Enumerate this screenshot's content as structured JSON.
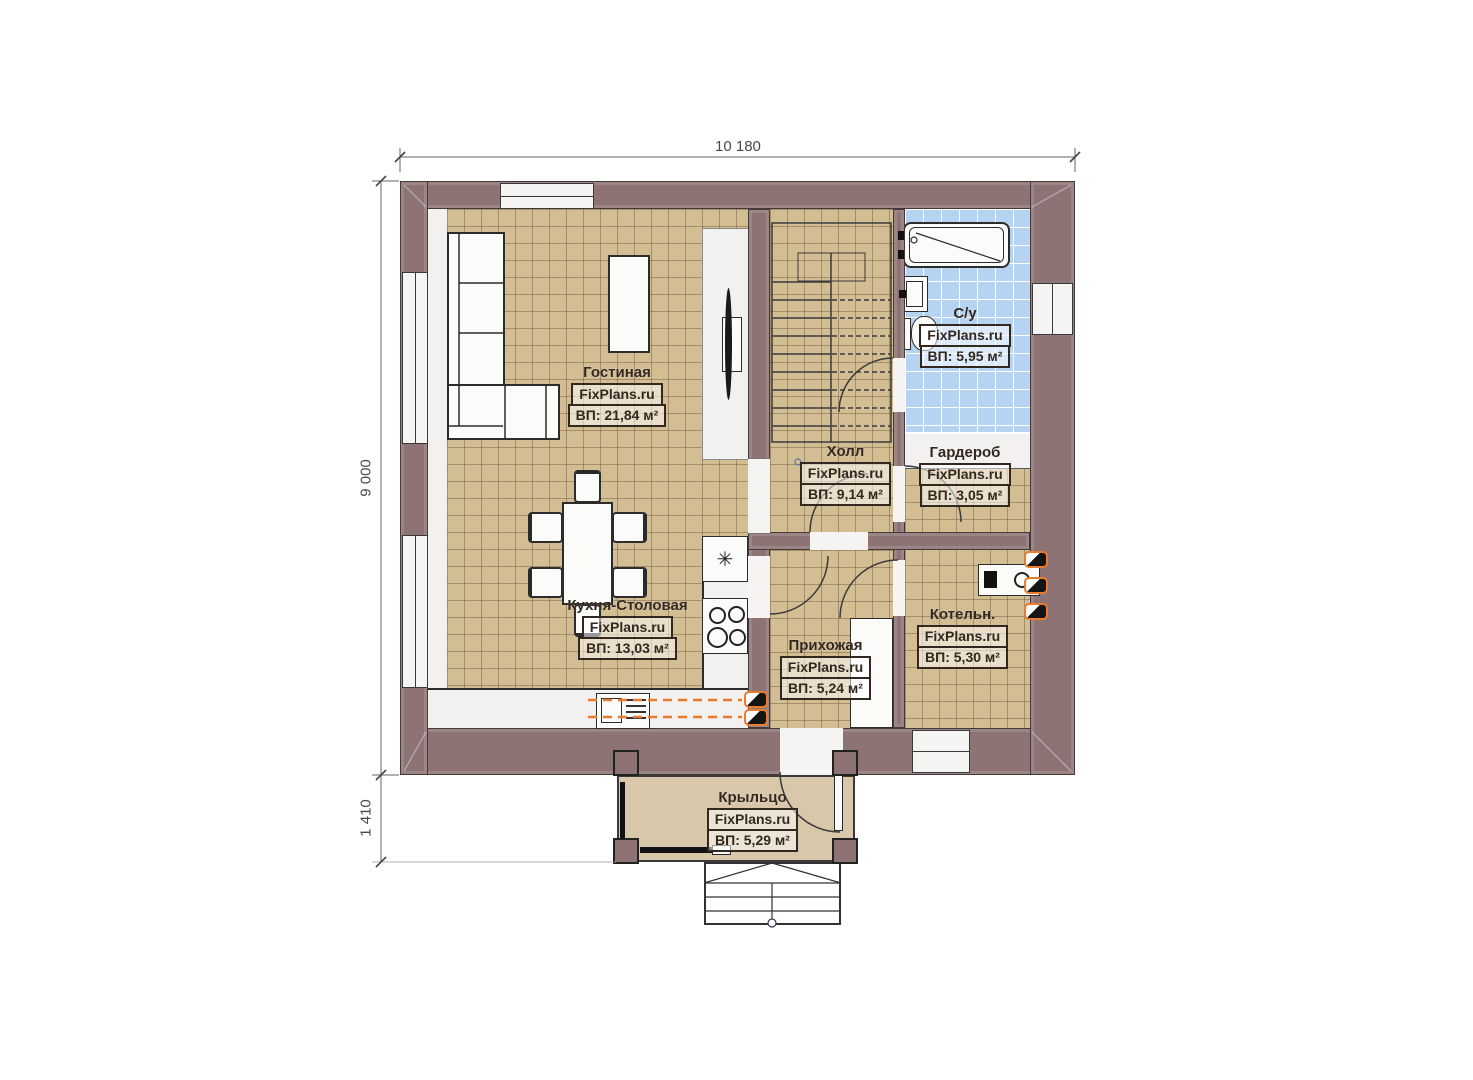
{
  "meta": {
    "brand": "FixPlans.ru",
    "drawing": "first-floor-plan"
  },
  "dimensions": {
    "width_total": "10 180",
    "height_main": "9 000",
    "height_porch": "1 410"
  },
  "rooms": [
    {
      "key": "living",
      "name": "Гостиная",
      "brand": "FixPlans.ru",
      "area": "ВП: 21,84 м²"
    },
    {
      "key": "kitchen",
      "name": "Кухня-Столовая",
      "brand": "FixPlans.ru",
      "area": "ВП: 13,03 м²"
    },
    {
      "key": "hall",
      "name": "Холл",
      "brand": "FixPlans.ru",
      "area": "ВП: 9,14 м²"
    },
    {
      "key": "bathroom",
      "name": "С/у",
      "brand": "FixPlans.ru",
      "area": "ВП: 5,95 м²"
    },
    {
      "key": "wardrobe",
      "name": "Гардероб",
      "brand": "FixPlans.ru",
      "area": "ВП: 3,05 м²"
    },
    {
      "key": "boiler",
      "name": "Котельн.",
      "brand": "FixPlans.ru",
      "area": "ВП: 5,30 м²"
    },
    {
      "key": "entry",
      "name": "Прихожая",
      "brand": "FixPlans.ru",
      "area": "ВП: 5,24 м²"
    },
    {
      "key": "porch",
      "name": "Крыльцо",
      "brand": "FixPlans.ru",
      "area": "ВП: 5,29 м²"
    }
  ],
  "icons": {
    "hob": "✳"
  },
  "colors": {
    "wall": "#8d7373",
    "floor_tile": "#d3bd93",
    "bathroom_tile": "#b7d3f2",
    "porch_floor": "#d8c8a9",
    "radiator_accent": "#e87b2e"
  }
}
